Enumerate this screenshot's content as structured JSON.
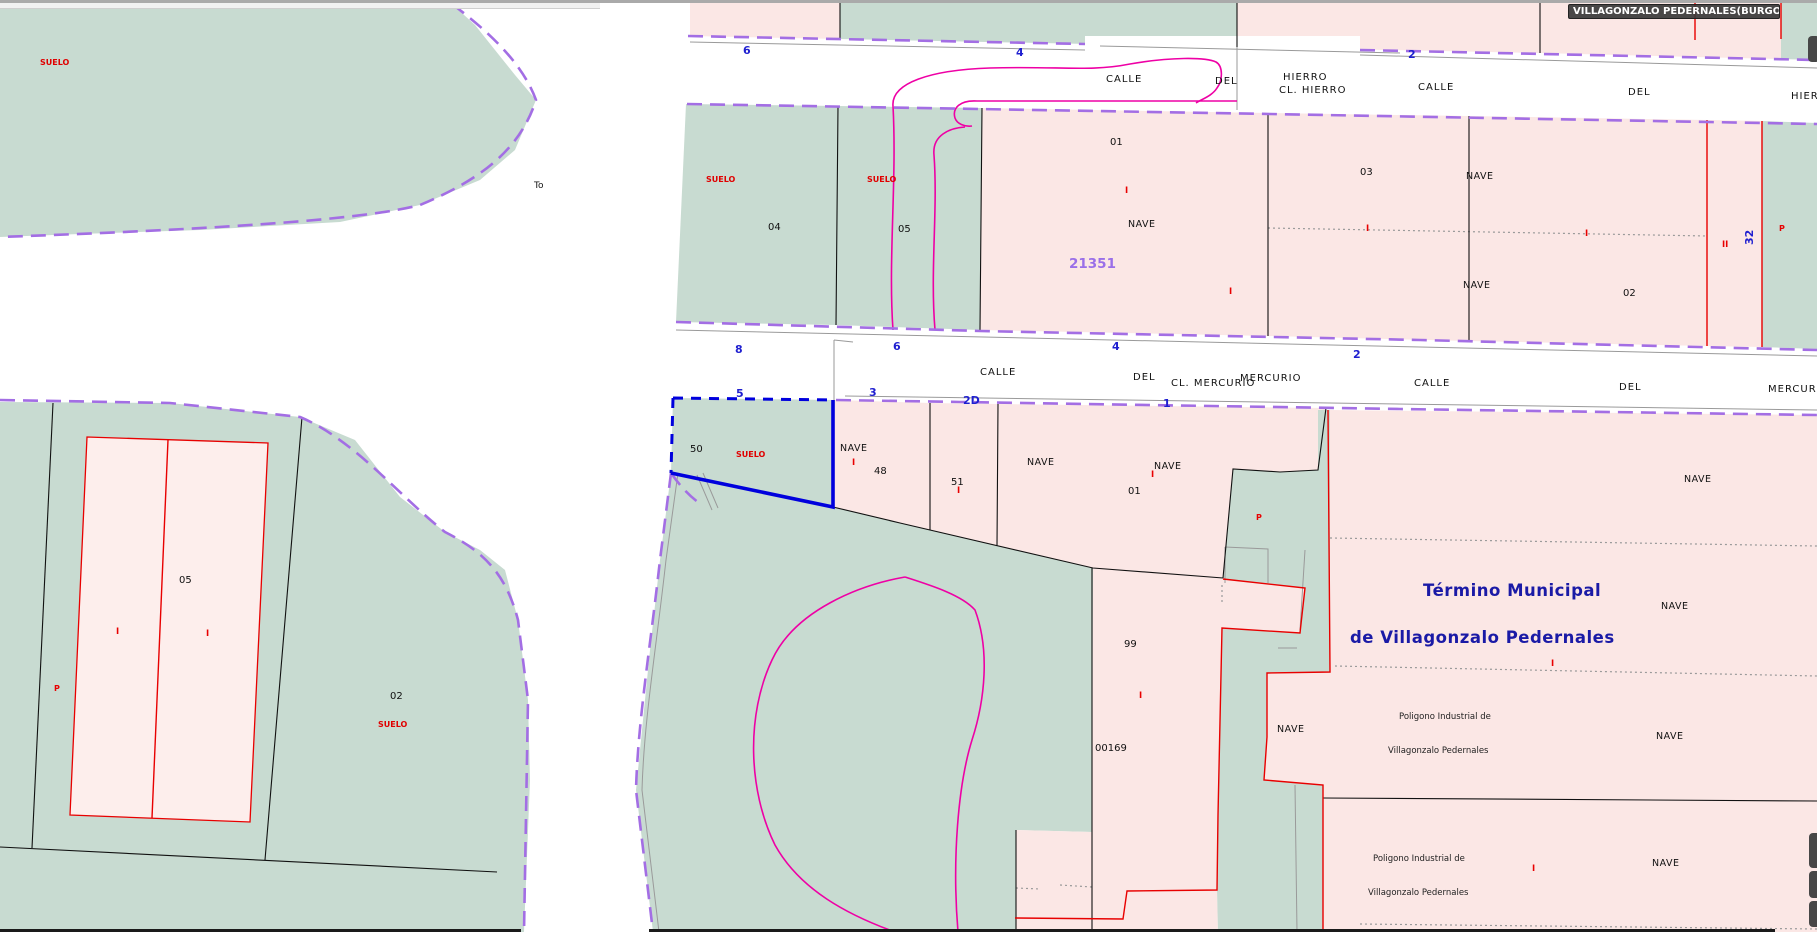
{
  "app": {
    "tooltip": "VILLAGONZALO PEDERNALES(BURGOS)"
  },
  "colors": {
    "parcel_green": "#c8dbd1",
    "parcel_pink": "#fbe7e5",
    "building_pink": "#fdeeec",
    "cadastral_limit_purple": "#a36ee4",
    "selection_blue": "#0000dd",
    "street_number_blue": "#1f1fd0",
    "contour_magenta": "#ee00a5",
    "label_red": "#e00000",
    "reference_purple": "#9a6fe8",
    "territory_navy": "#1a1aa6",
    "tooltip_bg": "#3a3a3a"
  },
  "selected_parcel": {
    "number": "50",
    "label": "SUELO"
  },
  "territory": {
    "line1": "Término Municipal",
    "line2": "de Villagonzalo Pedernales"
  },
  "map": {
    "labels": [
      {
        "name": "label-suelo-topleft",
        "cls": "suelo",
        "x": 40,
        "y": 65,
        "t": "SUELO"
      },
      {
        "name": "label-to",
        "cls": "to",
        "x": 534,
        "y": 188,
        "t": "To"
      },
      {
        "name": "street-calle-hierro-1a",
        "cls": "street",
        "x": 1106,
        "y": 82,
        "t": "CALLE"
      },
      {
        "name": "street-calle-hierro-1b",
        "cls": "street",
        "x": 1215,
        "y": 84,
        "t": "DEL"
      },
      {
        "name": "street-calle-hierro-1c",
        "cls": "street",
        "x": 1283,
        "y": 80,
        "t": "HIERRO"
      },
      {
        "name": "street-cl-hierro",
        "cls": "street",
        "x": 1279,
        "y": 93,
        "t": "CL. HIERRO"
      },
      {
        "name": "street-calle-hierro-2a",
        "cls": "street",
        "x": 1418,
        "y": 90,
        "t": "CALLE"
      },
      {
        "name": "street-calle-hierro-2b",
        "cls": "street",
        "x": 1628,
        "y": 95,
        "t": "DEL"
      },
      {
        "name": "street-calle-hierro-2c",
        "cls": "street",
        "x": 1791,
        "y": 99,
        "t": "HIERRO"
      },
      {
        "name": "street-calle-mercurio-1a",
        "cls": "street",
        "x": 980,
        "y": 375,
        "t": "CALLE"
      },
      {
        "name": "street-calle-mercurio-1b",
        "cls": "street",
        "x": 1133,
        "y": 380,
        "t": "DEL"
      },
      {
        "name": "street-cl-mercurio",
        "cls": "street",
        "x": 1171,
        "y": 386,
        "t": "CL. MERCURIO"
      },
      {
        "name": "street-calle-mercurio-1c",
        "cls": "street",
        "x": 1240,
        "y": 381,
        "t": "MERCURIO"
      },
      {
        "name": "street-calle-mercurio-2a",
        "cls": "street",
        "x": 1414,
        "y": 386,
        "t": "CALLE"
      },
      {
        "name": "street-calle-mercurio-2b",
        "cls": "street",
        "x": 1619,
        "y": 390,
        "t": "DEL"
      },
      {
        "name": "street-calle-mercurio-2c",
        "cls": "street",
        "x": 1768,
        "y": 392,
        "t": "MERCURIO"
      },
      {
        "name": "streetnum-hierro-6",
        "cls": "bluenum",
        "x": 743,
        "y": 54,
        "t": "6"
      },
      {
        "name": "streetnum-hierro-4",
        "cls": "bluenum",
        "x": 1016,
        "y": 56,
        "t": "4"
      },
      {
        "name": "streetnum-hierro-2",
        "cls": "bluenum",
        "x": 1408,
        "y": 58,
        "t": "2"
      },
      {
        "name": "streetnum-mercurio-8",
        "cls": "bluenum",
        "x": 735,
        "y": 353,
        "t": "8"
      },
      {
        "name": "streetnum-mercurio-6",
        "cls": "bluenum",
        "x": 893,
        "y": 350,
        "t": "6"
      },
      {
        "name": "streetnum-mercurio-4",
        "cls": "bluenum",
        "x": 1112,
        "y": 350,
        "t": "4"
      },
      {
        "name": "streetnum-mercurio-2",
        "cls": "bluenum",
        "x": 1353,
        "y": 358,
        "t": "2"
      },
      {
        "name": "streetnum-mercurio-5",
        "cls": "bluenum",
        "x": 736,
        "y": 397,
        "t": "5"
      },
      {
        "name": "streetnum-mercurio-3",
        "cls": "bluenum",
        "x": 869,
        "y": 396,
        "t": "3"
      },
      {
        "name": "streetnum-mercurio-2d",
        "cls": "bluenum",
        "x": 963,
        "y": 404,
        "t": "2D"
      },
      {
        "name": "streetnum-mercurio-1",
        "cls": "bluenum",
        "x": 1163,
        "y": 407,
        "t": "1"
      },
      {
        "name": "parcel-04-suelo",
        "cls": "suelo",
        "x": 706,
        "y": 182,
        "t": "SUELO"
      },
      {
        "name": "parcel-04-num",
        "cls": "num",
        "x": 768,
        "y": 230,
        "t": "04"
      },
      {
        "name": "parcel-05mid-suelo",
        "cls": "suelo",
        "x": 867,
        "y": 182,
        "t": "SUELO"
      },
      {
        "name": "parcel-05mid-num",
        "cls": "num",
        "x": 898,
        "y": 232,
        "t": "05"
      },
      {
        "name": "parcel-01-num",
        "cls": "num",
        "x": 1110,
        "y": 145,
        "t": "01"
      },
      {
        "name": "parcel-01-storey",
        "cls": "roman",
        "x": 1125,
        "y": 193,
        "t": "I"
      },
      {
        "name": "parcel-01-nave",
        "cls": "nave",
        "x": 1128,
        "y": 227,
        "t": "NAVE"
      },
      {
        "name": "parcel-01-ref",
        "cls": "ref",
        "x": 1069,
        "y": 268,
        "t": "21351"
      },
      {
        "name": "parcel-01-storey2",
        "cls": "roman",
        "x": 1229,
        "y": 294,
        "t": "I"
      },
      {
        "name": "parcel-03-num",
        "cls": "num",
        "x": 1360,
        "y": 175,
        "t": "03"
      },
      {
        "name": "parcel-03-nave",
        "cls": "nave",
        "x": 1466,
        "y": 179,
        "t": "NAVE"
      },
      {
        "name": "dotline-storey-1",
        "cls": "roman",
        "x": 1366,
        "y": 231,
        "t": "I"
      },
      {
        "name": "dotline-storey-2",
        "cls": "roman",
        "x": 1585,
        "y": 236,
        "t": "I"
      },
      {
        "name": "parcel-03-nave2",
        "cls": "nave",
        "x": 1463,
        "y": 288,
        "t": "NAVE"
      },
      {
        "name": "parcel-02mid-num",
        "cls": "num",
        "x": 1623,
        "y": 296,
        "t": "02"
      },
      {
        "name": "parcel-g4-storeys",
        "cls": "roman",
        "x": 1722,
        "y": 247,
        "t": "II"
      },
      {
        "name": "parcel-g4-num32",
        "cls": "bluenum",
        "x": 1753,
        "y": 245,
        "t": "32",
        "rot": -90
      },
      {
        "name": "parcel-g5-p",
        "cls": "pmark",
        "x": 1779,
        "y": 231,
        "t": "P"
      },
      {
        "name": "parcel-50-num",
        "cls": "num",
        "x": 690,
        "y": 452,
        "t": "50"
      },
      {
        "name": "parcel-50-suelo",
        "cls": "suelo",
        "x": 736,
        "y": 457,
        "t": "SUELO"
      },
      {
        "name": "parcel-48-nave",
        "cls": "nave",
        "x": 840,
        "y": 451,
        "t": "NAVE"
      },
      {
        "name": "parcel-48-storey",
        "cls": "roman",
        "x": 852,
        "y": 465,
        "t": "I"
      },
      {
        "name": "parcel-48-num",
        "cls": "num",
        "x": 874,
        "y": 474,
        "t": "48"
      },
      {
        "name": "parcel-51-num",
        "cls": "num",
        "x": 951,
        "y": 485,
        "t": "51"
      },
      {
        "name": "parcel-51-storey",
        "cls": "roman",
        "x": 957,
        "y": 493,
        "t": "I"
      },
      {
        "name": "parcel-01s-nave1",
        "cls": "nave",
        "x": 1027,
        "y": 465,
        "t": "NAVE"
      },
      {
        "name": "parcel-01s-nave2",
        "cls": "nave",
        "x": 1154,
        "y": 469,
        "t": "NAVE"
      },
      {
        "name": "parcel-01s-storey",
        "cls": "roman",
        "x": 1151,
        "y": 477,
        "t": "I"
      },
      {
        "name": "parcel-01s-num",
        "cls": "num",
        "x": 1128,
        "y": 494,
        "t": "01"
      },
      {
        "name": "building-05-num",
        "cls": "num",
        "x": 179,
        "y": 583,
        "t": "05"
      },
      {
        "name": "building-05-storey1",
        "cls": "roman",
        "x": 116,
        "y": 634,
        "t": "I"
      },
      {
        "name": "building-05-storey2",
        "cls": "roman",
        "x": 206,
        "y": 636,
        "t": "I"
      },
      {
        "name": "parcel-02sw-p",
        "cls": "pmark",
        "x": 54,
        "y": 691,
        "t": "P"
      },
      {
        "name": "parcel-02sw-num",
        "cls": "num",
        "x": 390,
        "y": 699,
        "t": "02"
      },
      {
        "name": "parcel-02sw-suelo",
        "cls": "suelo",
        "x": 378,
        "y": 727,
        "t": "SUELO"
      },
      {
        "name": "parcel-99-num",
        "cls": "num",
        "x": 1124,
        "y": 647,
        "t": "99"
      },
      {
        "name": "parcel-99-storey",
        "cls": "roman",
        "x": 1139,
        "y": 698,
        "t": "I"
      },
      {
        "name": "parcel-99-ref",
        "cls": "refnum",
        "x": 1095,
        "y": 751,
        "t": "00169"
      },
      {
        "name": "corridor-p",
        "cls": "pmark",
        "x": 1256,
        "y": 520,
        "t": "P"
      },
      {
        "name": "corridor-nave",
        "cls": "nave",
        "x": 1277,
        "y": 732,
        "t": "NAVE"
      },
      {
        "name": "right-nave-1",
        "cls": "nave",
        "x": 1684,
        "y": 482,
        "t": "NAVE"
      },
      {
        "name": "right-nave-2",
        "cls": "nave",
        "x": 1661,
        "y": 609,
        "t": "NAVE"
      },
      {
        "name": "right-storey-1",
        "cls": "roman",
        "x": 1551,
        "y": 666,
        "t": "I"
      },
      {
        "name": "right-poligono-1a",
        "cls": "small",
        "x": 1399,
        "y": 719,
        "t": "Poligono Industrial de"
      },
      {
        "name": "right-nave-3",
        "cls": "nave",
        "x": 1656,
        "y": 739,
        "t": "NAVE"
      },
      {
        "name": "right-poligono-1b",
        "cls": "small",
        "x": 1388,
        "y": 753,
        "t": "Villagonzalo Pedernales"
      },
      {
        "name": "right-poligono-2a",
        "cls": "small",
        "x": 1373,
        "y": 861,
        "t": "Poligono Industrial de"
      },
      {
        "name": "right-storey-2",
        "cls": "roman",
        "x": 1532,
        "y": 871,
        "t": "I"
      },
      {
        "name": "right-nave-4",
        "cls": "nave",
        "x": 1652,
        "y": 866,
        "t": "NAVE"
      },
      {
        "name": "right-poligono-2b",
        "cls": "small",
        "x": 1368,
        "y": 895,
        "t": "Villagonzalo Pedernales"
      }
    ],
    "titles": [
      {
        "name": "territory-title-line1",
        "cls": "title",
        "x": 1423,
        "y": 596,
        "bind": "territory.line1"
      },
      {
        "name": "territory-title-line2",
        "cls": "title",
        "x": 1350,
        "y": 643,
        "bind": "territory.line2"
      }
    ]
  }
}
